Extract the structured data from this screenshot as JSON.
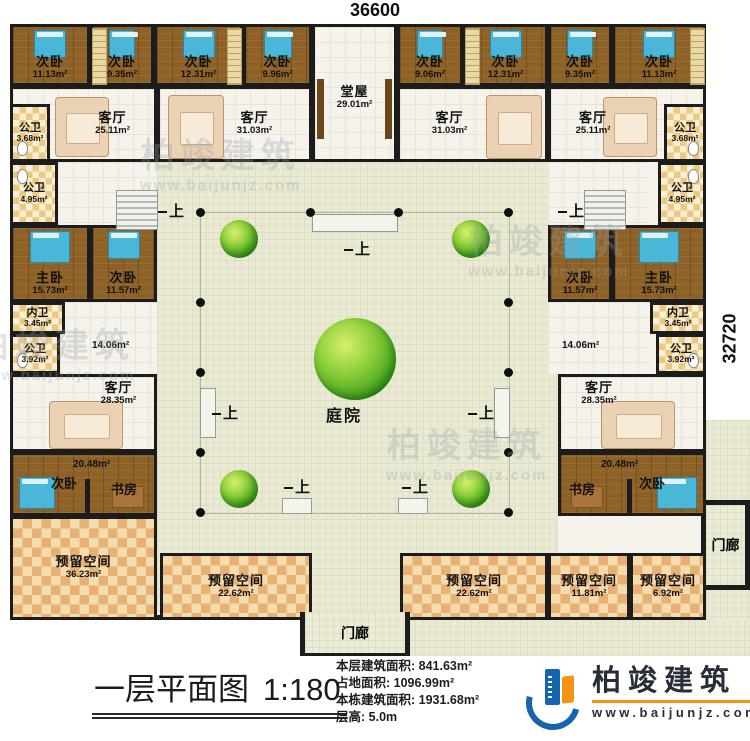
{
  "plan": {
    "dim_top": "36600",
    "dim_right": "32720",
    "stair_label": "上",
    "watermark": {
      "name": "柏竣建筑",
      "url": "www.baijunjz.com"
    },
    "colors": {
      "wall": "#1c1c1c",
      "wood_floor": "#8e6227",
      "bath_tile": "#ebc983",
      "reserve_tile": "#e7b174",
      "courtyard": "#eaead4",
      "tree": "#47a41f",
      "bed": "#4ab7d8"
    },
    "rooms": [
      {
        "name": "次卧",
        "area": "11.13m²"
      },
      {
        "name": "次卧",
        "area": "9.35m²"
      },
      {
        "name": "次卧",
        "area": "12.31m²"
      },
      {
        "name": "次卧",
        "area": "9.96m²"
      },
      {
        "name": "堂屋",
        "area": "29.01m²"
      },
      {
        "name": "次卧",
        "area": "9.06m²"
      },
      {
        "name": "次卧",
        "area": "12.31m²"
      },
      {
        "name": "次卧",
        "area": "9.35m²"
      },
      {
        "name": "次卧",
        "area": "11.13m²"
      },
      {
        "name": "公卫",
        "area": "3.68m²"
      },
      {
        "name": "客厅",
        "area": "25.11m²"
      },
      {
        "name": "客厅",
        "area": "31.03m²"
      },
      {
        "name": "客厅",
        "area": "31.03m²"
      },
      {
        "name": "客厅",
        "area": "25.11m²"
      },
      {
        "name": "公卫",
        "area": "3.68m²"
      },
      {
        "name": "公卫",
        "area": "4.95m²"
      },
      {
        "name": "公卫",
        "area": "4.95m²"
      },
      {
        "name": "主卧",
        "area": "15.73m²"
      },
      {
        "name": "次卧",
        "area": "11.57m²"
      },
      {
        "name": "次卧",
        "area": "11.57m²"
      },
      {
        "name": "主卧",
        "area": "15.73m²"
      },
      {
        "name": "内卫",
        "area": "3.45m²"
      },
      {
        "name": "公卫",
        "area": "3.92m²"
      },
      {
        "name": "内卫",
        "area": "3.45m²"
      },
      {
        "name": "公卫",
        "area": "3.92m²"
      },
      {
        "area": "14.06m²"
      },
      {
        "area": "14.06m²"
      },
      {
        "name": "客厅",
        "area": "28.35m²"
      },
      {
        "name": "客厅",
        "area": "28.35m²"
      },
      {
        "area": "20.48m²"
      },
      {
        "name": "次卧"
      },
      {
        "name": "书房"
      },
      {
        "area": "20.48m²"
      },
      {
        "name": "书房"
      },
      {
        "name": "次卧"
      },
      {
        "name": "预留空间",
        "area": "36.23m²"
      },
      {
        "name": "预留空间",
        "area": "22.62m²"
      },
      {
        "name": "预留空间",
        "area": "22.62m²"
      },
      {
        "name": "预留空间",
        "area": "11.81m²"
      },
      {
        "name": "预留空间",
        "area": "6.92m²"
      },
      {
        "name": "门廊"
      },
      {
        "name": "门廊"
      },
      {
        "name": "庭院"
      }
    ]
  },
  "titleblock": {
    "title": "一层平面图",
    "scale": "1:180",
    "stats": [
      {
        "label": "本层建筑面积:",
        "value": "841.63m²"
      },
      {
        "label": "占地面积:",
        "value": "1096.99m²"
      },
      {
        "label": "本栋建筑面积:",
        "value": "1931.68m²"
      },
      {
        "label": "层高:",
        "value": "5.0m"
      }
    ],
    "logo": {
      "name": "柏竣建筑",
      "url": "www.baijunjz.com"
    }
  }
}
